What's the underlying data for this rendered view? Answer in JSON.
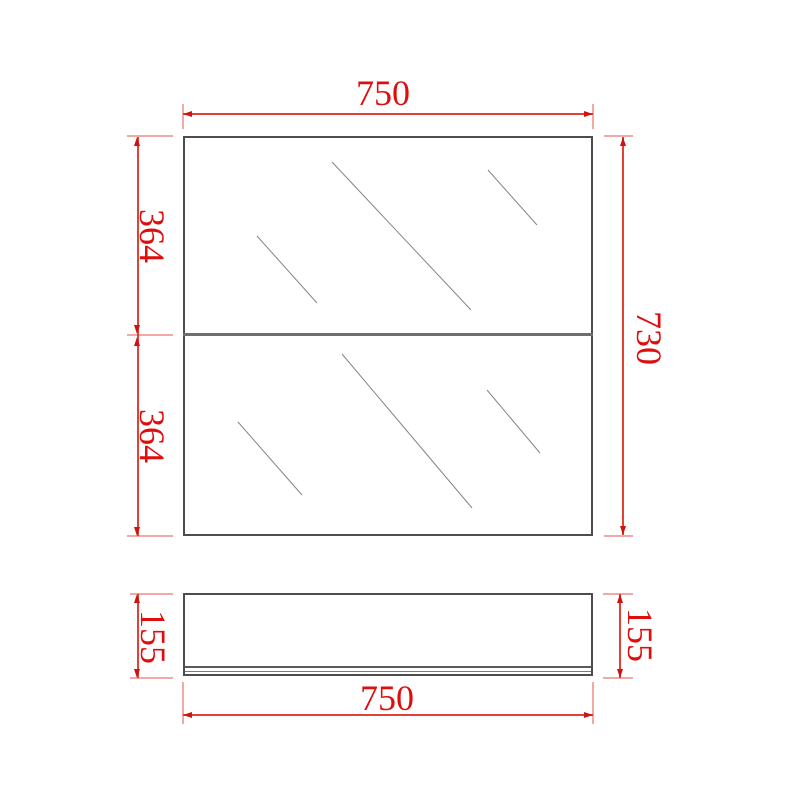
{
  "drawing": {
    "type": "mirror-cabinet dimension drawing",
    "labels": {
      "front_width": "750",
      "front_height": "730",
      "panel_top": "364",
      "panel_bottom": "364",
      "side_height_left": "155",
      "side_height_right": "155",
      "side_width": "750"
    },
    "colors": {
      "dimension_red": "#e34036",
      "extension_pink": "#f1a9a5",
      "arrow_red": "#cf1410",
      "text_red": "#e00d0d",
      "outline_gray": "#4d4d4d",
      "hatch_gray": "#858585",
      "background": "#ffffff"
    }
  }
}
